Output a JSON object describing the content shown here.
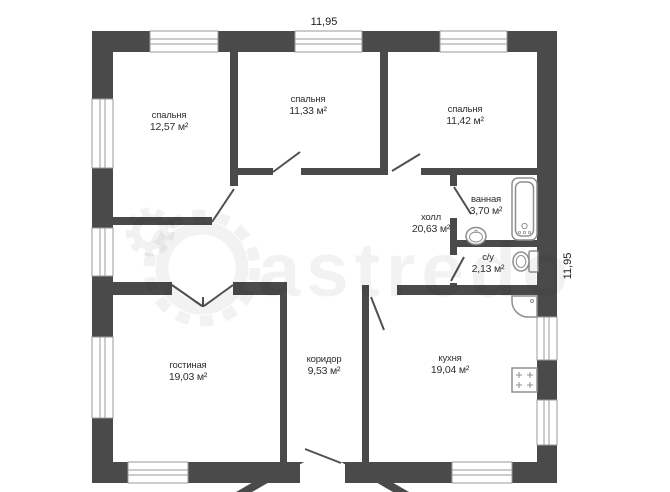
{
  "plan": {
    "title": "apartment-floor-plan",
    "dimensions": {
      "top": "11,95",
      "right": "11,95"
    },
    "rooms": [
      {
        "id": "bedroom-1",
        "name": "спальня",
        "area": "12,57 м²"
      },
      {
        "id": "bedroom-2",
        "name": "спальня",
        "area": "11,33 м²"
      },
      {
        "id": "bedroom-3",
        "name": "спальня",
        "area": "11,42 м²"
      },
      {
        "id": "bathroom",
        "name": "ванная",
        "area": "3,70 м²"
      },
      {
        "id": "hall",
        "name": "холл",
        "area": "20,63 м²"
      },
      {
        "id": "wc",
        "name": "с/у",
        "area": "2,13 м²"
      },
      {
        "id": "living",
        "name": "гостиная",
        "area": "19,03 м²"
      },
      {
        "id": "corridor",
        "name": "коридор",
        "area": "9,53 м²"
      },
      {
        "id": "kitchen",
        "name": "кухня",
        "area": "19,04 м²"
      }
    ],
    "fixtures": [
      "bathtub",
      "bathroom-sink",
      "toilet",
      "kitchen-sink",
      "stove"
    ],
    "watermark": {
      "text": "astredo"
    },
    "colors": {
      "wall": "#4a4a4a",
      "window_frame": "#9a9a9a",
      "fixture_outline": "#8f8f8f",
      "label_text": "#2e2e2e",
      "watermark": "rgba(0,0,0,0.05)"
    }
  }
}
